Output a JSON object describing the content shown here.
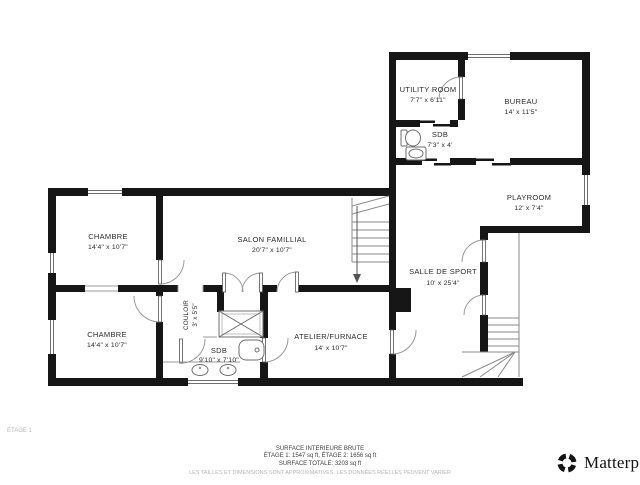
{
  "floor_label": "ÉTAGE 1",
  "rooms": {
    "chambre1": {
      "name": "CHAMBRE",
      "dims": "14'4\" x 10'7\""
    },
    "chambre2": {
      "name": "CHAMBRE",
      "dims": "14'4\" x 10'7\""
    },
    "salon": {
      "name": "SALON FAMILLIAL",
      "dims": "20'7\" x 10'7\""
    },
    "couloir": {
      "name": "COULOIR",
      "dims": "3' x 5'5\""
    },
    "sdb_bas": {
      "name": "SDB",
      "dims": "9'10\" x 7'10\""
    },
    "atelier": {
      "name": "ATELIER/FURNACE",
      "dims": "14' x 10'7\""
    },
    "sport": {
      "name": "SALLE DE SPORT",
      "dims": "10' x 25'4\""
    },
    "utility": {
      "name": "UTILITY ROOM",
      "dims": "7'7\" x 6'11\""
    },
    "sdb_haut": {
      "name": "SDB",
      "dims": "7'3\" x 4'"
    },
    "bureau": {
      "name": "BUREAU",
      "dims": "14' x 11'5\""
    },
    "playroom": {
      "name": "PLAYROOM",
      "dims": "12' x 7'4\""
    }
  },
  "footer": {
    "line1": "SURFACE INTERIEURE BRUTE",
    "line2": "ÉTAGE 1: 1547 sq ft, ÉTAGE 2: 1656 sq ft",
    "line3": "SURFACE TOTALE: 3203 sq ft",
    "disclaimer": "LES TAILLES ET DIMENSIONS SONT APPROXIMATIVES, LES DONNÉES RÉELLES PEUVENT VARIER"
  },
  "branding": {
    "logo_text": "Matterport"
  },
  "colors": {
    "wall": "#161616",
    "label_text": "#2b2b2b",
    "footer_text": "#3f3f3f",
    "muted_text": "#b5b5b5",
    "background": "#ffffff"
  }
}
